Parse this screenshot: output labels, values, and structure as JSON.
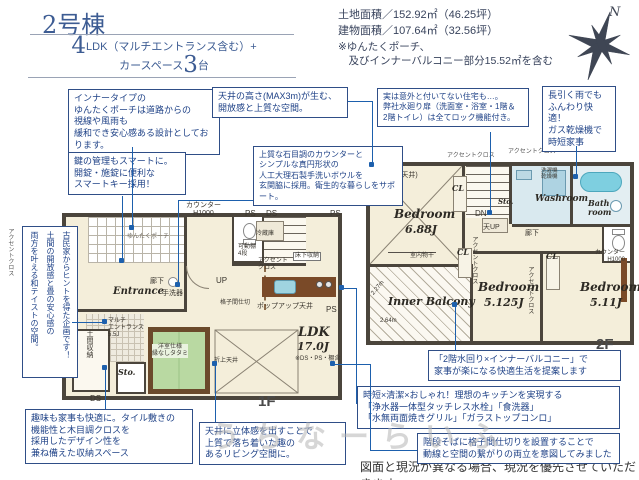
{
  "header": {
    "building_no": "2号棟",
    "plan_big": "4",
    "plan_rest": "LDK（マルチエントランス含む）+",
    "car_prefix": "カースペース",
    "car_big": "3",
    "car_suffix": "台",
    "land_area": "土地面積／152.92㎡（46.25坪）",
    "building_area": "建物面積／107.64㎡（32.56坪）",
    "area_note1": "※ゆんたくポーチ、",
    "area_note2": "　及びインナーバルコニー部分15.52㎡を含む",
    "compass_n": "N"
  },
  "callouts": {
    "porch": "インナータイプの\nゆんたくポーチは道路からの\n視線や風雨も\n緩和でき安心感ある設計としております。",
    "smart_key": "鍵の管理もスマートに。\n開錠・施錠に便利な\nスマートキー採用！",
    "ceiling_max": "天井の高さ(MAX3m)が生む、\n開放感と上質な空間。",
    "wash_bowl": "上質な石目調のカウンターと\nシンプルな真円形状の\n人工大理石製手洗いボウルを\n玄関脇に採用。衛生的な暮らしをサポート。",
    "door_lock": "実は意外と付いてない住宅も…。\n弊社水廻り扉（洗面室・浴室・1階＆\n2階トイレ）は全てロック機能付き。",
    "gas_dryer": "長引く雨でも\nふんわり快適！\nガス乾燥機で\n時短家事",
    "kominka": "古民家からヒントを得た企画です！\n土間の開放感と畳の安心感の\n両方を叶える和テイストの空間。",
    "storage_space": "趣味も家事も快適に。タイル敷きの\n機能性と木目調クロスを\n採用したデザイン性を\n兼ね備えた収納スペース",
    "living_ceiling": "天井に立体感を出すことで\n上質で落ち着いた趣の\nあるリビング空間に。",
    "mizumawari": "「2階水回り×インナーバルコニー」で\n家事が楽になる快適生活を提案します",
    "kitchen": "時短×清潔×おしゃれ！理想のキッチンを実現する\n「浄水器一体型タッチレス水栓」「食洗器」\n「水無両面焼きグリル」「ガラストップコンロ」",
    "lattice": "階段そばに格子間仕切りを設置することで\n動線と空間の繋がりの両立を意図してみました"
  },
  "floor1": {
    "label": "1F",
    "porch": "ゆんたくポーチ",
    "entrance": "Entrance",
    "hallway": "廊下",
    "counter": "カウンター\nH1000",
    "ps": "PS",
    "ds": "DS",
    "fridge": "冷蔵庫",
    "shelf": "可動棚\n4段",
    "accent": "アクセント\nクロス",
    "underfloor": "床下収納",
    "handwash": "手洗器",
    "up": "UP",
    "lattice": "格子間仕切",
    "popup": "ポップアップ天井",
    "ldk": "LDK",
    "ldk_size": "17.0J",
    "ldk_note": "※DS・PS・棚含",
    "tatami": "洋室仕様\n縁なしタタミ",
    "coffered": "折上天井",
    "doma": "土間収納",
    "sto": "Sto.",
    "multi": "マルチ\nエントランス\n5.5J",
    "accent_v": "アクセントクロス",
    "shelf_v": "可動棚4段"
  },
  "floor2": {
    "label": "2F",
    "accent1": "アクセントクロス",
    "accent2": "アクセントクロス",
    "sloped": "(勾配天井)",
    "bed1": "Bedroom",
    "bed1_size": "6.88J",
    "drying": "室内物干",
    "cl": "CL",
    "dn": "DN",
    "ceil_up": "天UP",
    "sto": "Sto.",
    "washroom": "Washroom",
    "washer": "洗濯機\n乾燥機",
    "bath": "Bath\nroom",
    "hallway": "廊下",
    "accent_v1": "アクセントクロス",
    "accent_v2": "アクセントクロス",
    "counter": "カウンター\nH1000",
    "bed2": "Bedroom",
    "bed2_size": "5.125J",
    "bed3": "Bedroom",
    "bed3_size": "5.11J",
    "balcony": "Inner Balcony",
    "dim_w": "2.64m",
    "dim_h": "2.27m"
  },
  "footer": {
    "disclaimer": "図面と現況が異なる場合、現況を優先させていただきます。"
  },
  "watermark": "うちなーらいふ"
}
